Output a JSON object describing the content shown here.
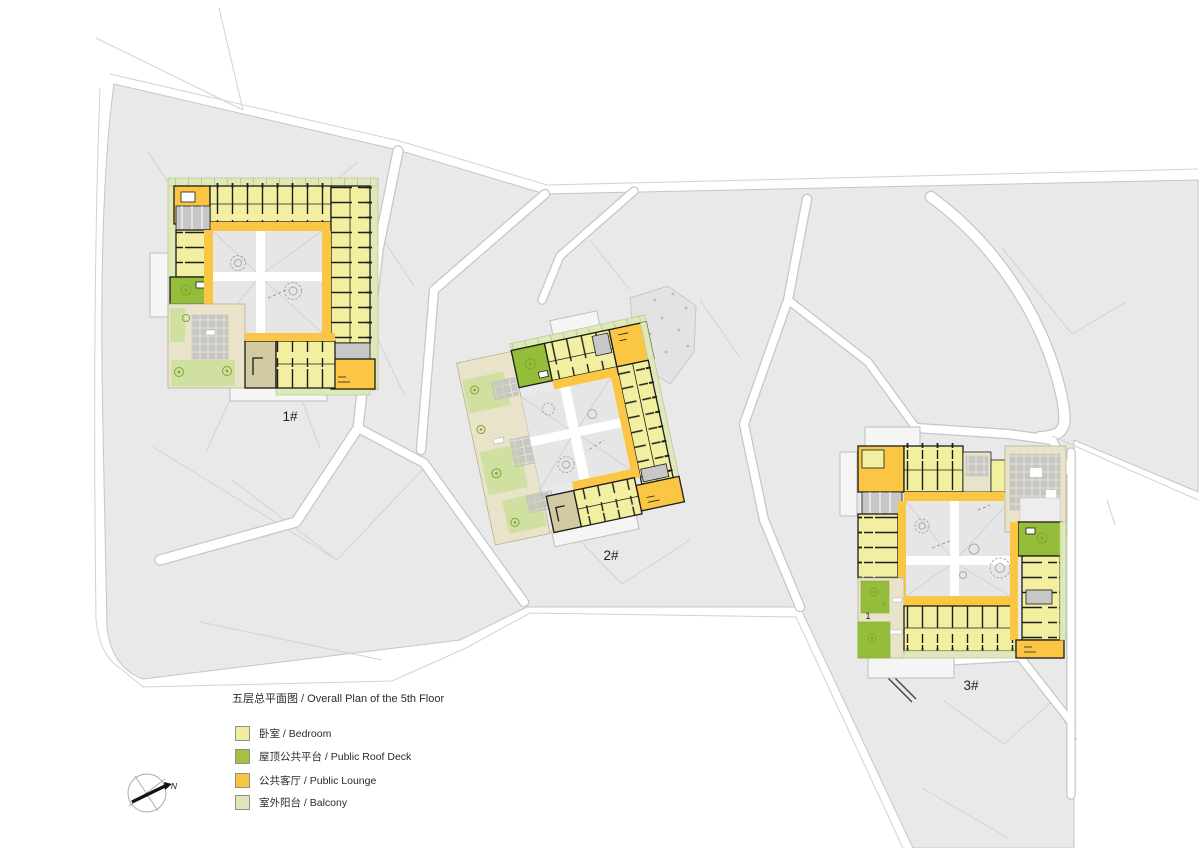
{
  "plan": {
    "title": "五层总平面图 / Overall Plan of the 5th Floor"
  },
  "legend": {
    "items": [
      {
        "id": "bedroom",
        "label": "卧室 / Bedroom",
        "color": "#f0ed9f"
      },
      {
        "id": "roof-deck",
        "label": "屋顶公共平台 / Public Roof Deck",
        "color": "#a5c23e"
      },
      {
        "id": "lounge",
        "label": "公共客厅 / Public Lounge",
        "color": "#f9c440"
      },
      {
        "id": "balcony",
        "label": "室外阳台 / Balcony",
        "color": "#dce8b8"
      }
    ]
  },
  "buildings": [
    {
      "id": "building-1",
      "label": "1#"
    },
    {
      "id": "building-2",
      "label": "2#"
    },
    {
      "id": "building-3",
      "label": "3#"
    }
  ],
  "annotations": {
    "unit_label": "1"
  },
  "compass": {
    "north_label": "N"
  },
  "colors": {
    "bedroom": "#f2efa0",
    "lounge": "#fbc644",
    "roofdeck": "#94bd3a",
    "balcony": "#dfe9b8",
    "lawn": "#cfe0a0",
    "terrace": "#e8e3c9",
    "terraceDark": "#d2caa0",
    "utility": "#c7c7c7",
    "parcel": "#e9e9e9",
    "parcelLine": "#c6c6c6",
    "courtyard": "#e6e6e6",
    "wall": "#1c1c1c",
    "hairline": "#d2d2d2",
    "underlay": "#f5f5f5",
    "underlayLine": "#bdbdbd",
    "tree": "#7fa636",
    "treeOutline": "#a9a9a9",
    "text": "#1f1f1f",
    "paving": "#c6c6c6"
  }
}
